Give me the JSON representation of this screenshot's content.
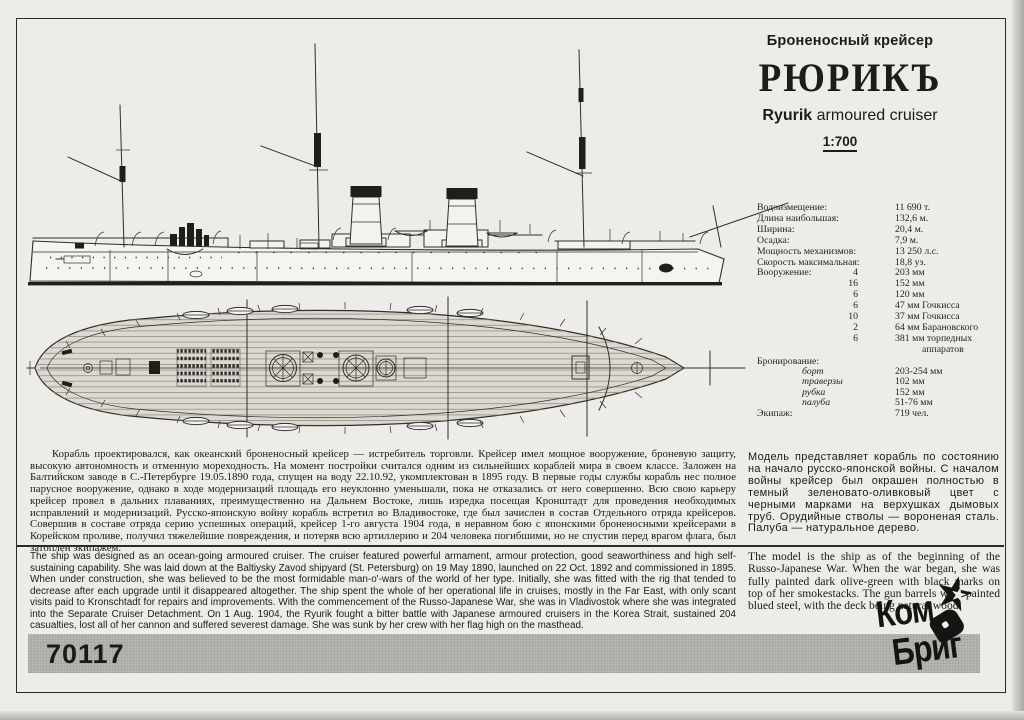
{
  "header": {
    "class_ru": "Броненосный крейсер",
    "ship_name": "РЮРИКЪ",
    "name_en_bold": "Ryurik",
    "name_en_rest": " armoured cruiser",
    "scale": "1:700"
  },
  "specs": {
    "rows": [
      {
        "label": "Водоизмещение:",
        "qty": "",
        "value": "11 690 т."
      },
      {
        "label": "Длина наибольшая:",
        "qty": "",
        "value": "132,6 м."
      },
      {
        "label": "Ширина:",
        "qty": "",
        "value": "20,4 м."
      },
      {
        "label": "Осадка:",
        "qty": "",
        "value": "7,9 м."
      },
      {
        "label": "Мощность механизмов:",
        "qty": "",
        "value": "13 250 л.с."
      },
      {
        "label": "Скорость максимальная:",
        "qty": "",
        "value": "18,8 уз."
      },
      {
        "label": "Вооружение:",
        "qty": "4",
        "value": "203 мм"
      },
      {
        "label": "",
        "qty": "16",
        "value": "152 мм"
      },
      {
        "label": "",
        "qty": "6",
        "value": "120 мм"
      },
      {
        "label": "",
        "qty": "6",
        "value": "47 мм Гочкисса"
      },
      {
        "label": "",
        "qty": "10",
        "value": "37 мм Гочкисса"
      },
      {
        "label": "",
        "qty": "2",
        "value": "64 мм Барановского"
      },
      {
        "label": "",
        "qty": "6",
        "value": "381 мм торпедных"
      },
      {
        "label": "",
        "qty": "",
        "value": "аппаратов"
      }
    ]
  },
  "armor": {
    "title": "Бронирование:",
    "rows": [
      {
        "label": "борт",
        "value": "203-254 мм"
      },
      {
        "label": "траверзы",
        "value": "102 мм"
      },
      {
        "label": "рубка",
        "value": "152 мм"
      },
      {
        "label": "палуба",
        "value": "51-76 мм"
      }
    ],
    "crew_label": "Экипаж:",
    "crew_value": "719 чел."
  },
  "history_ru": "Корабль проектировался, как океанский броненосный крейсер — истребитель торговли. Крейсер имел мощное вооружение, броневую защиту, высокую автономность и отменную мореходность. На момент постройки считался одним из сильнейших кораблей мира в своем классе. Заложен на Балтийском заводе в С.-Петербурге 19.05.1890 года, спущен на воду 22.10.92, укомплектован в 1895 году. В первые годы службы корабль нес полное парусное вооружение, однако в ходе модернизаций площадь его неуклонно уменьшали, пока не отказались от него совершенно. Всю свою карьеру крейсер провел в дальних плаваниях, преимущественно на Дальнем Востоке, лишь изредка посещая Кронштадт для проведения необходимых исправлений и модернизаций. Русско-японскую войну корабль встретил во Владивостоке, где был зачислен в состав Отдельного отряда крейсеров. Совершив в составе отряда серию успешных операций, крейсер 1-го августа 1904 года, в неравном бою с японскими броненосными крейсерами в Корейском проливе, получил тяжелейшие повреждения, и потеряв всю артиллерию и 204 человека погибшими, но не спустив перед врагом флага, был затоплен экипажем.",
  "paint_ru": "Модель представляет корабль по состоянию на начало русско-японской войны. С началом войны крейсер был окрашен полностью в темный зеленовато-оливковый цвет с черными марками на верхушках дымовых труб. Орудийные стволы — вороненая сталь. Палуба — натуральное дерево.",
  "history_en": "The ship was designed as an ocean-going armoured cruiser. The cruiser featured powerful armament, armour protection, good seaworthiness and high self-sustaining capability. She was laid down at the Baltiysky Zavod shipyard (St. Petersburg) on 19 May 1890, launched on 22 Oct. 1892 and commissioned in 1895. When under construction, she was believed to be the most formidable man-o'-wars of the world of her type. Initially, she was fitted with the rig that tended to decrease after each upgrade until it disappeared altogether. The ship spent the whole of her operational life in cruises, mostly in the Far East, with only scant visits paid to Kronschtadt for repairs and improvements. With the commencement of the Russo-Japanese War, she was in Vladivostok where she was integrated into the Separate Cruiser Detachment. On 1 Aug. 1904, the Ryurik fought a bitter battle with Japanese armoured cruisers in the Korea Strait, sustained 204 casualties, lost all of her cannon and suffered severest damage. She was sunk by her crew with her flag high on the masthead.",
  "paint_en": "The model is the ship as of the beginning of the Russo-Japanese War. When the war began, she was fully painted dark olive-green with black marks on top of her smokestacks. The gun barrels were painted blued steel, with the deck being natural wood.",
  "footer": {
    "kit_number": "70117",
    "logo_line1": "Ком",
    "logo_line2": "Бриг",
    "colors": {
      "band_gray": "#b7b5b0",
      "paper": "#ecebe7",
      "ink": "#2f2e2b"
    }
  }
}
